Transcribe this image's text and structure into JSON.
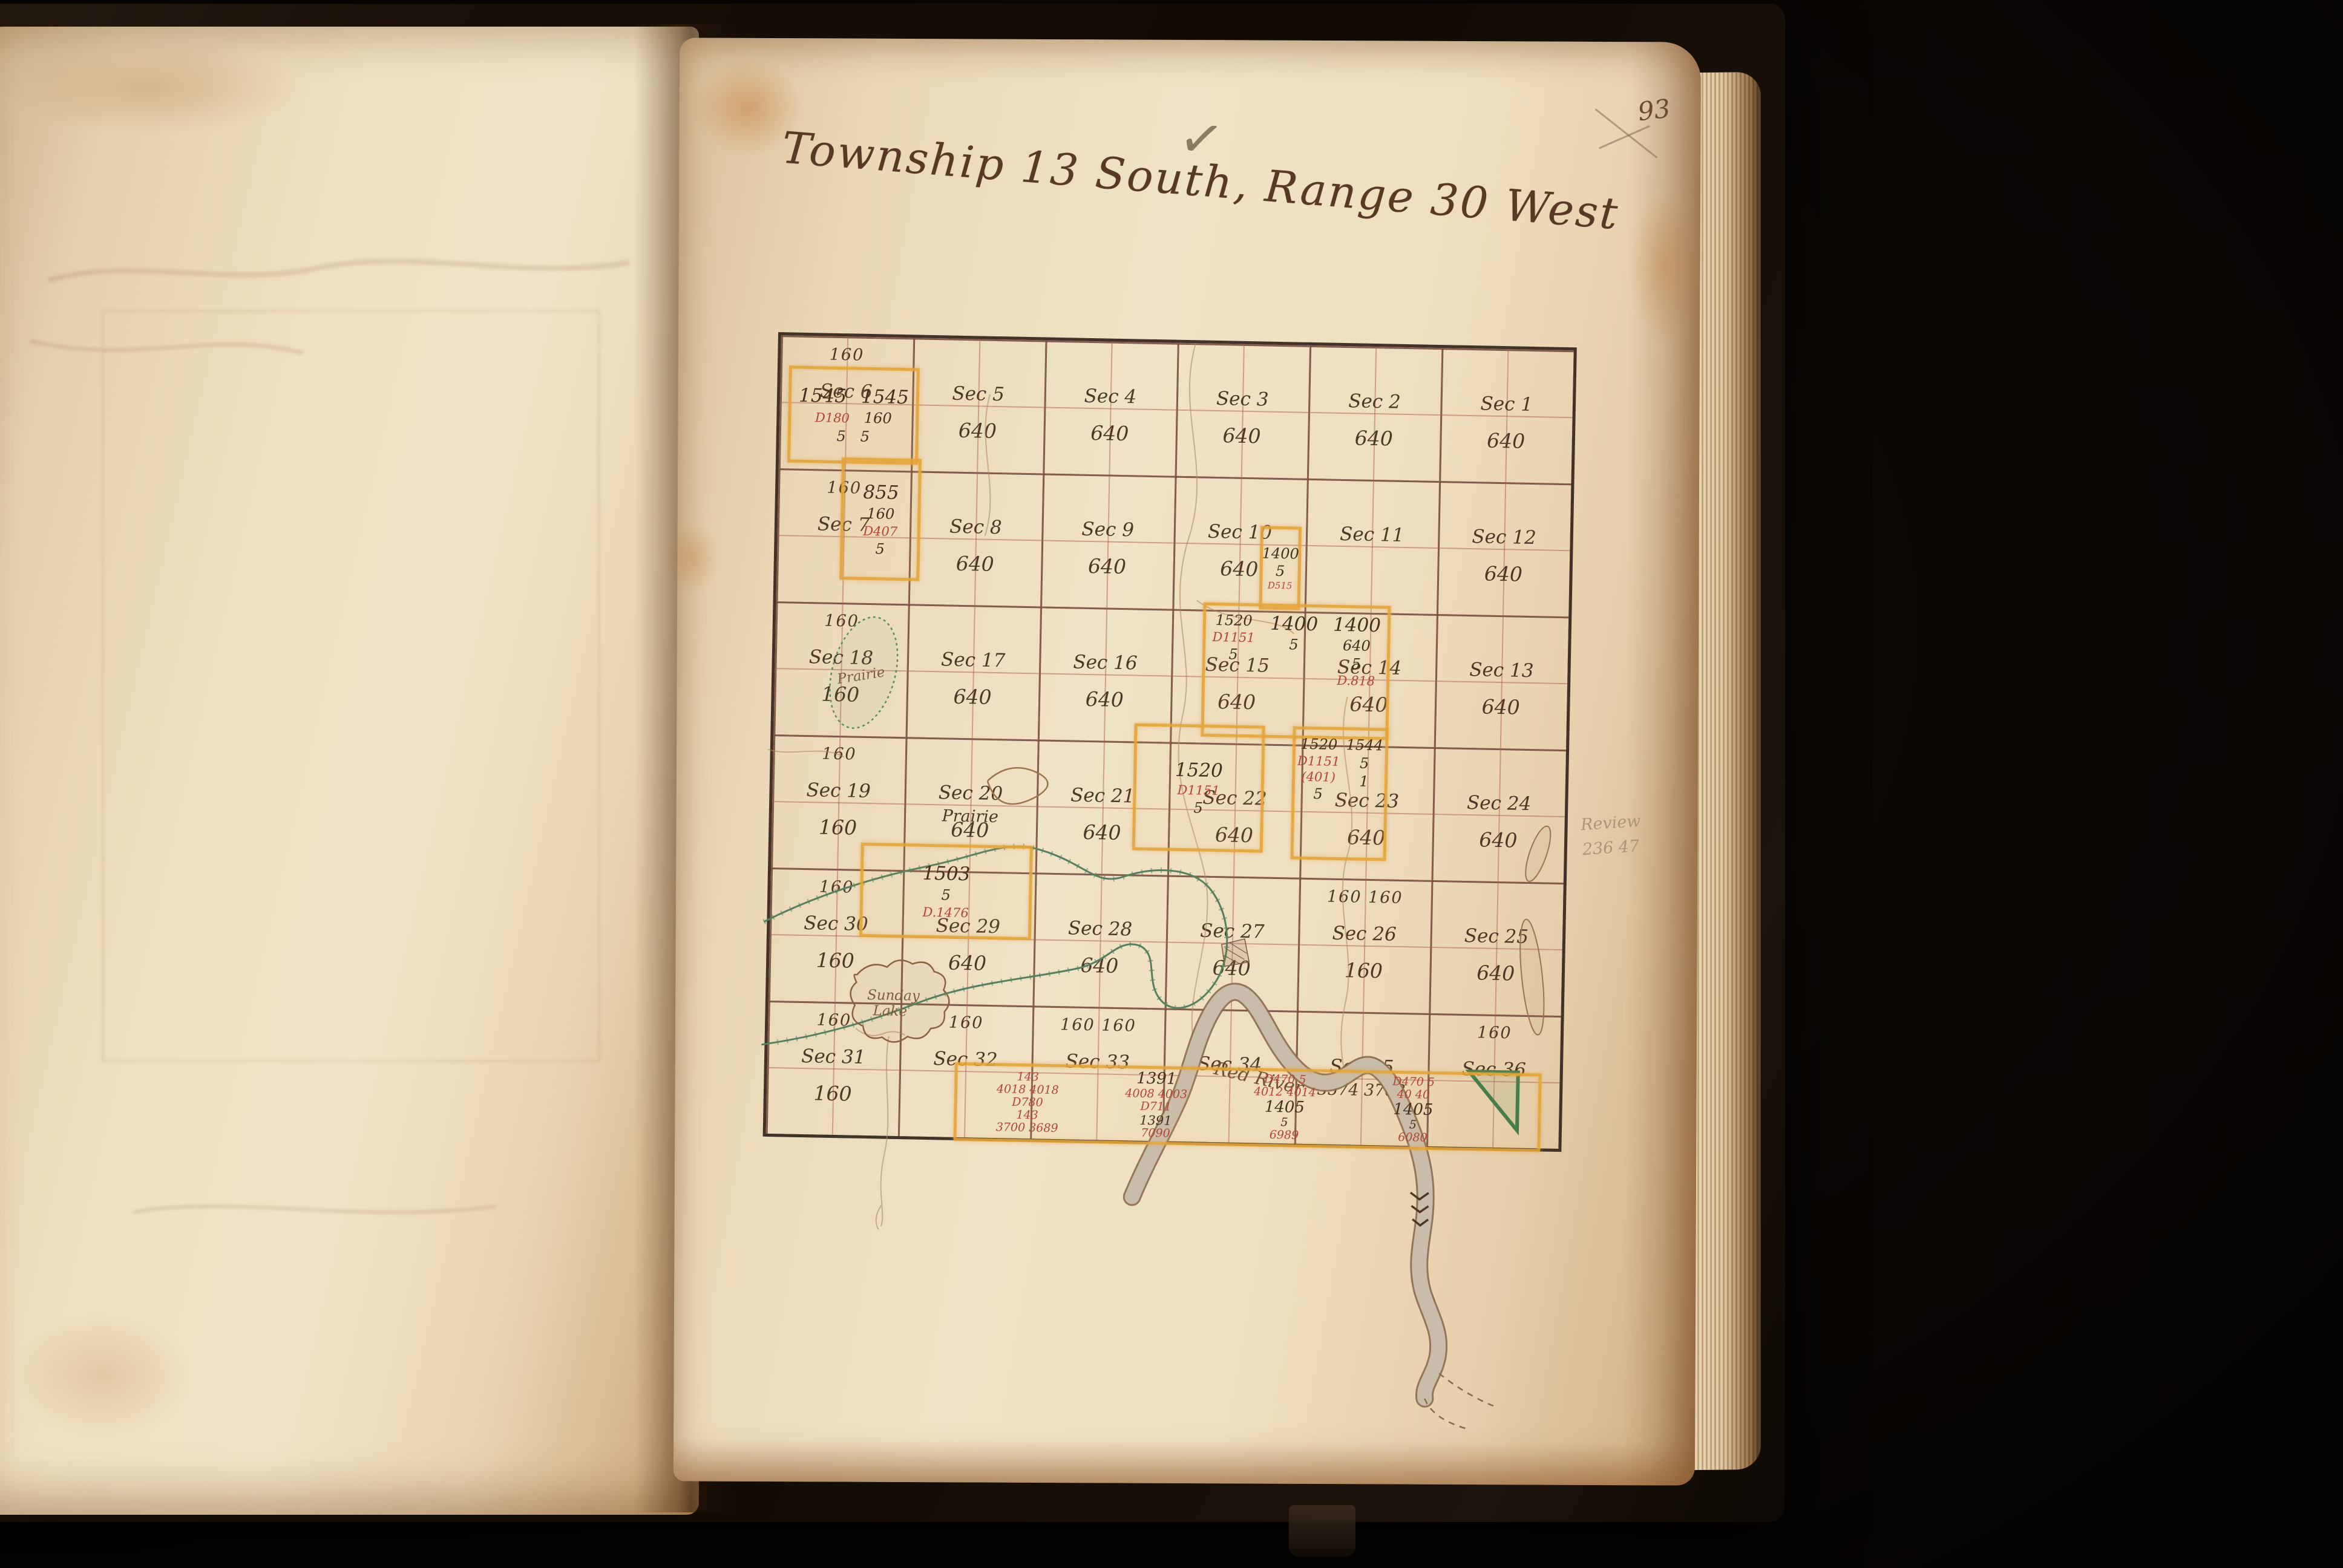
{
  "book": {
    "page_number": "93"
  },
  "header": {
    "title": "Township 13 South, Range 30 West",
    "checkmark": "✓"
  },
  "margin_notes": {
    "pencil_line1": "Review",
    "pencil_line2": "236 47"
  },
  "water": {
    "river": "Red River",
    "lake_line1": "Sunday",
    "lake_line2": "Lake",
    "pond": "Prairie"
  },
  "sections": [
    {
      "sec": "Sec 6",
      "top": "160",
      "note": "",
      "acres": ""
    },
    {
      "sec": "Sec 5",
      "top": "",
      "note": "",
      "acres": "640"
    },
    {
      "sec": "Sec 4",
      "top": "",
      "note": "",
      "acres": "640"
    },
    {
      "sec": "Sec 3",
      "top": "",
      "note": "",
      "acres": "640"
    },
    {
      "sec": "Sec 2",
      "top": "",
      "note": "",
      "acres": "640"
    },
    {
      "sec": "Sec 1",
      "top": "",
      "note": "",
      "acres": "640"
    },
    {
      "sec": "Sec 7",
      "top": "160",
      "note": "",
      "acres": ""
    },
    {
      "sec": "Sec 8",
      "top": "",
      "note": "",
      "acres": "640"
    },
    {
      "sec": "Sec 9",
      "top": "",
      "note": "",
      "acres": "640"
    },
    {
      "sec": "Sec 10",
      "top": "",
      "note": "",
      "acres": "640"
    },
    {
      "sec": "Sec 11",
      "top": "",
      "note": "",
      "acres": ""
    },
    {
      "sec": "Sec 12",
      "top": "",
      "note": "",
      "acres": "640"
    },
    {
      "sec": "Sec 18",
      "top": "160",
      "note": "",
      "acres": "160"
    },
    {
      "sec": "Sec 17",
      "top": "",
      "note": "",
      "acres": "640"
    },
    {
      "sec": "Sec 16",
      "top": "",
      "note": "",
      "acres": "640"
    },
    {
      "sec": "Sec 15",
      "top": "",
      "note": "",
      "acres": "640"
    },
    {
      "sec": "Sec 14",
      "top": "",
      "note": "",
      "acres": "640"
    },
    {
      "sec": "Sec 13",
      "top": "",
      "note": "",
      "acres": "640"
    },
    {
      "sec": "Sec 19",
      "top": "160",
      "note": "",
      "acres": "160"
    },
    {
      "sec": "Sec 20",
      "top": "",
      "note": "Prairie",
      "acres": "640"
    },
    {
      "sec": "Sec 21",
      "top": "",
      "note": "",
      "acres": "640"
    },
    {
      "sec": "Sec 22",
      "top": "",
      "note": "",
      "acres": "640"
    },
    {
      "sec": "Sec 23",
      "top": "",
      "note": "",
      "acres": "640"
    },
    {
      "sec": "Sec 24",
      "top": "",
      "note": "",
      "acres": "640"
    },
    {
      "sec": "Sec 30",
      "top": "160",
      "note": "",
      "acres": "160"
    },
    {
      "sec": "Sec 29",
      "top": "",
      "note": "",
      "acres": "640"
    },
    {
      "sec": "Sec 28",
      "top": "",
      "note": "",
      "acres": "640"
    },
    {
      "sec": "Sec 27",
      "top": "",
      "note": "",
      "acres": "640"
    },
    {
      "sec": "Sec 26",
      "top": "160  160",
      "note": "",
      "acres": "160"
    },
    {
      "sec": "Sec 25",
      "top": "",
      "note": "",
      "acres": "640"
    },
    {
      "sec": "Sec 31",
      "top": "160",
      "note": "",
      "acres": "160"
    },
    {
      "sec": "Sec 32",
      "top": "160",
      "note": "",
      "acres": ""
    },
    {
      "sec": "Sec 33",
      "top": "160  160",
      "note": "",
      "acres": ""
    },
    {
      "sec": "Sec 34",
      "top": "",
      "note": "",
      "acres": ""
    },
    {
      "sec": "Sec 35",
      "top": "",
      "note": "3574    3763",
      "acres": ""
    },
    {
      "sec": "Sec 36",
      "top": "160",
      "note": "",
      "acres": ""
    }
  ],
  "claims": {
    "c1": {
      "v1": "1545",
      "v2": "1545",
      "d": "D180",
      "q": "160",
      "s1": "5",
      "s2": "5"
    },
    "c2": {
      "v": "855",
      "q": "160",
      "d": "D407",
      "s": "5"
    },
    "c3": {
      "v": "1400",
      "s": "5",
      "d": "D515"
    },
    "c4": {
      "l1": "1520",
      "ld": "D1151",
      "ls": "5",
      "m1": "1400",
      "ms": "5",
      "r1": "1400",
      "r2": "640",
      "rs": "5",
      "rd": "D.818"
    },
    "c5": {
      "v": "1520",
      "d": "D1151",
      "s": "5"
    },
    "c6": {
      "v": "1520",
      "d": "D1151",
      "d2": "(401)",
      "s": "5",
      "v2": "1544",
      "s2": "5",
      "s3": "1"
    },
    "c7": {
      "v": "1503",
      "s": "5",
      "d": "D.1476"
    }
  },
  "strip": {
    "col1": {
      "r1": "143",
      "r2": "4018  4018",
      "r3": "D780",
      "r4": "143",
      "r5": "3700  3689",
      "r6": "5"
    },
    "col2": {
      "r1": "1391",
      "r2": "4008  4003",
      "r3": "D711",
      "r4": "1391",
      "r5": "7090",
      "r6": "5"
    },
    "col3": {
      "r1": "D470  5",
      "r2": "4012  4014",
      "b1": "1405",
      "b2": "5",
      "r3": "D470",
      "r4": "6989"
    },
    "col4": {
      "r1": "D470  5",
      "r2": "40    40",
      "b1": "1405",
      "b2": "5",
      "r4": "6080"
    }
  },
  "colors": {
    "highlight": "#e4a33a",
    "red_ink": "#b4443a",
    "green": "#4f7d58",
    "grid_red": "#ad5e50",
    "ink": "#4d3827",
    "page": "#efe0c4",
    "cover": "#160f08"
  }
}
